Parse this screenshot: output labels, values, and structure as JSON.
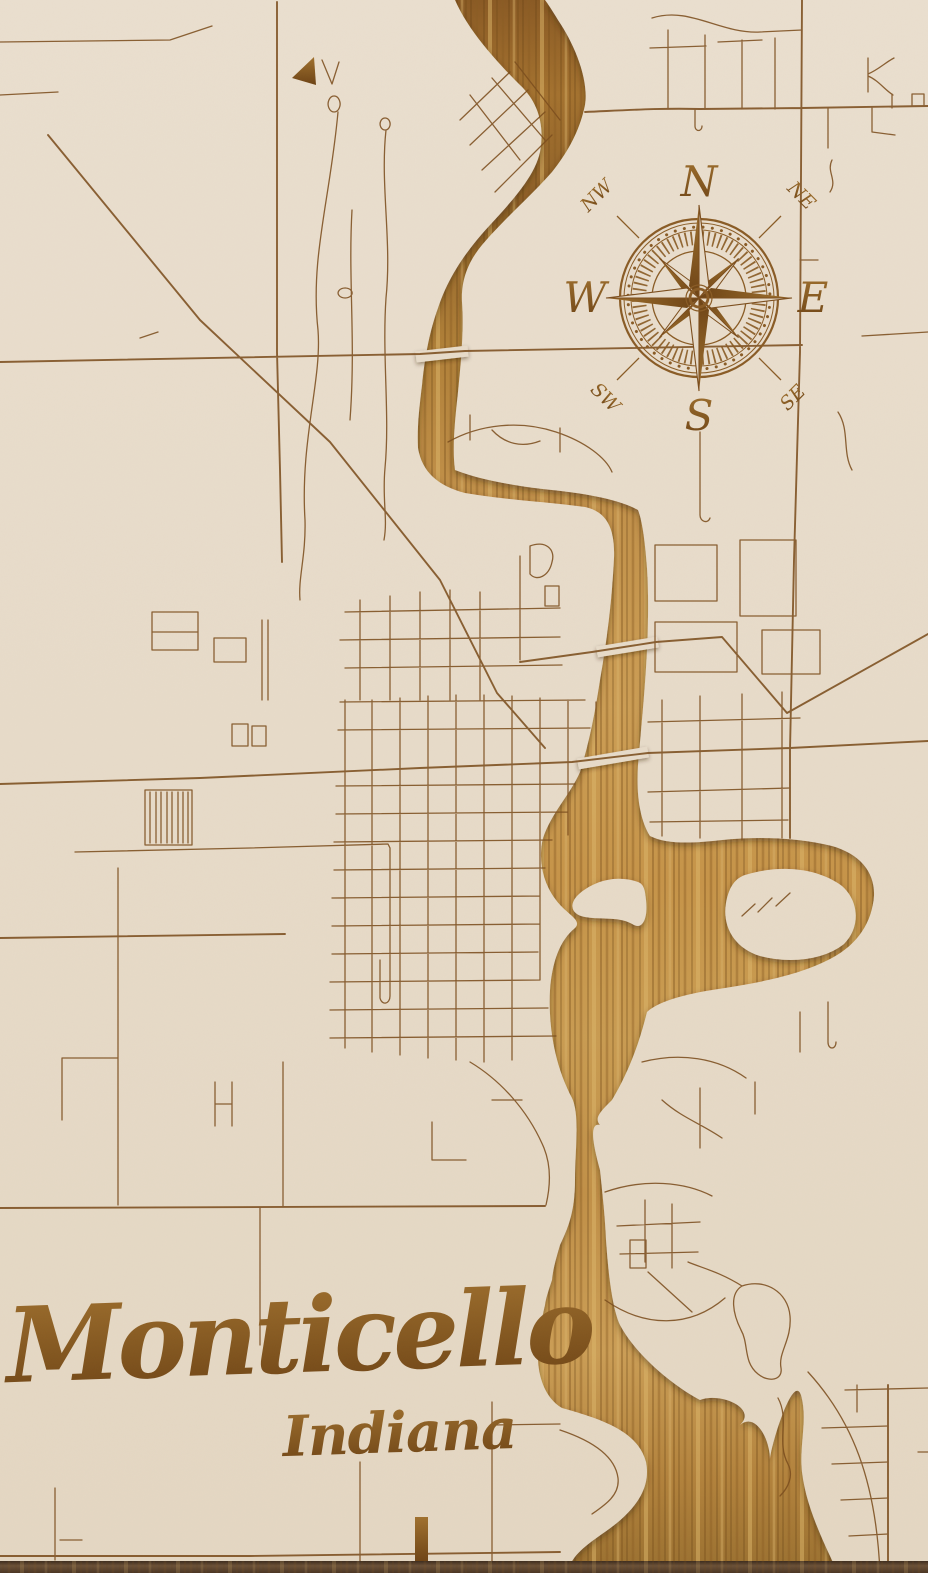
{
  "map": {
    "kind": "laser-engraved wooden street map",
    "title": "Monticello",
    "subtitle": "Indiana",
    "compass": {
      "n": "N",
      "ne": "NE",
      "e": "E",
      "se": "SE",
      "s": "S",
      "sw": "SW",
      "w": "W",
      "nw": "NW"
    },
    "colors": {
      "land_cream": "#e7dbc9",
      "street_brown": "#7c4e1e",
      "wood_light": "#d9b366",
      "wood_mid": "#c3924a",
      "wood_dark": "#7d5222",
      "ink_brown": "#7a4e1d",
      "board_edge": "#584130"
    }
  }
}
